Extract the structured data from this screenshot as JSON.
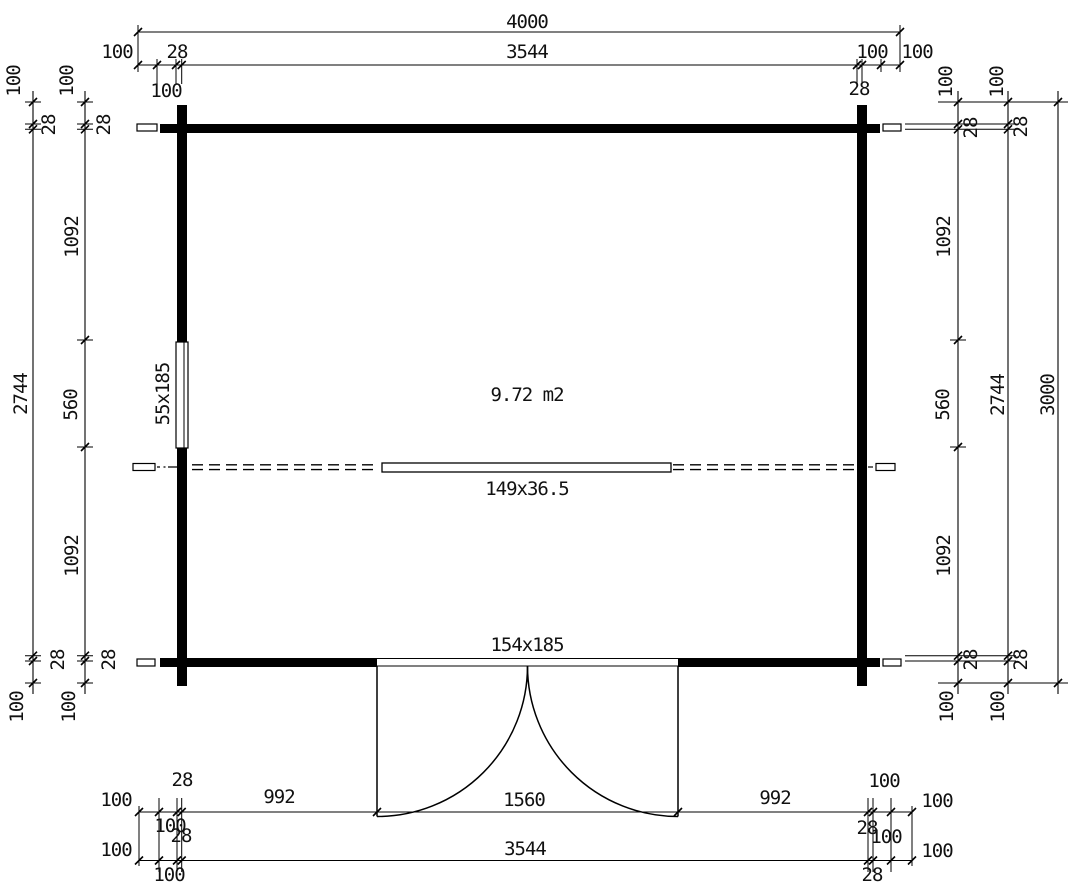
{
  "drawing": {
    "area_label": "9.72 m2",
    "ridge_beam_label": "149x36.5",
    "door_size_label": "154x185",
    "window_size_label": "55x185"
  },
  "dims": {
    "top": {
      "overall": "4000",
      "row": [
        "100",
        "28",
        "3544",
        "100",
        "100"
      ],
      "sub": [
        "100",
        "28"
      ]
    },
    "left": {
      "col_a": [
        "100",
        "28",
        "2744",
        "28",
        "100"
      ],
      "col_b": [
        "100",
        "28",
        "1092",
        "560",
        "1092",
        "28",
        "100"
      ]
    },
    "right": {
      "col_c": [
        "100",
        "28",
        "1092",
        "560",
        "1092",
        "28",
        "100"
      ],
      "col_d": [
        "100",
        "28",
        "2744",
        "28",
        "100"
      ],
      "col_e": "3000"
    },
    "bottom": {
      "row1": [
        "28",
        "100",
        "992",
        "1560",
        "992",
        "100",
        "100"
      ],
      "mid": [
        "100",
        "28",
        "28",
        "100"
      ],
      "row2": [
        "100",
        "3544",
        "100"
      ],
      "row2_sub": [
        "100",
        "28"
      ]
    }
  }
}
